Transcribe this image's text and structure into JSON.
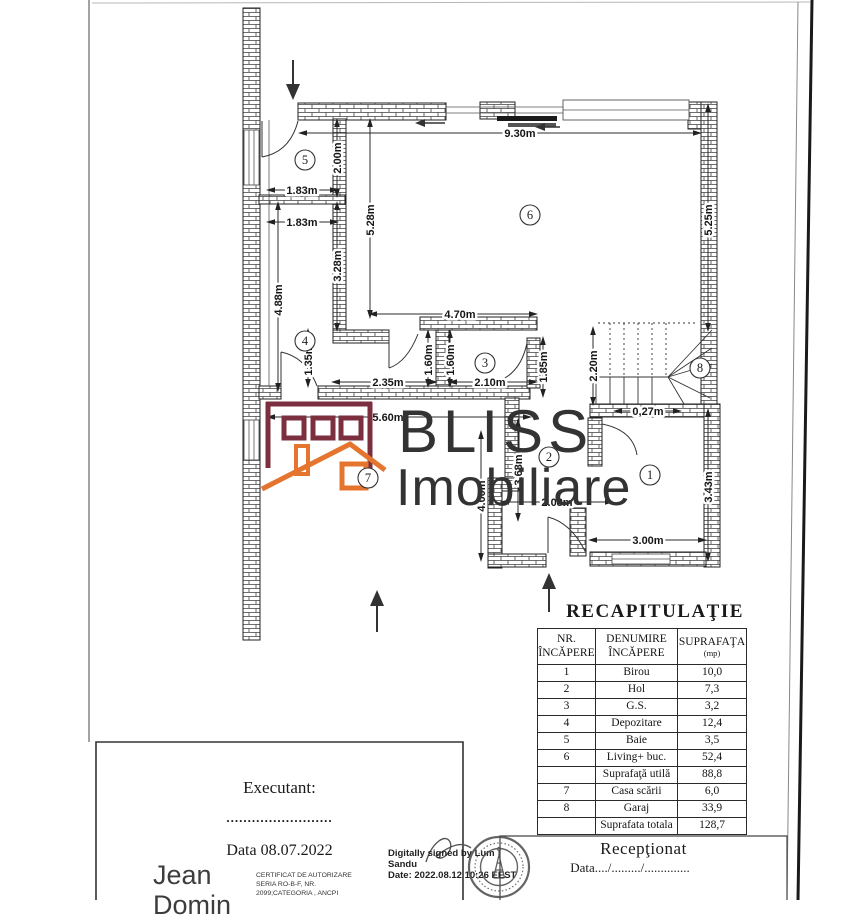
{
  "logo": {
    "title": "BLISS",
    "subtitle": "Imobiliare",
    "maroon": "#7b2f3f",
    "orange": "#e4742e"
  },
  "plan": {
    "dims": [
      "9.30m",
      "2.00m",
      "1.83m",
      "1.83m",
      "5.28m",
      "3.28m",
      "4.88m",
      "5.25m",
      "4.70m",
      "1.35m",
      "2.35m",
      "1.60m",
      "1.60m",
      "2.10m",
      "1.85m",
      "5.60m",
      "2.20m",
      "0,27m",
      "4.00m",
      "3.68m",
      "2.08m",
      "3.00m",
      "3.43m"
    ],
    "rooms": [
      "1",
      "2",
      "3",
      "4",
      "5",
      "6",
      "7",
      "8"
    ]
  },
  "recap": {
    "title": "RECAPITULAŢIE",
    "headers": {
      "col1_line1": "NR.",
      "col1_line2": "ÎNCĂPERE",
      "col2_line1": "DENUMIRE",
      "col2_line2": "ÎNCĂPERE",
      "col3_line1": "SUPRAFAŢA",
      "col3_line2": "(mp)"
    },
    "rows": [
      {
        "nr": "1",
        "name": "Birou",
        "area": "10,0"
      },
      {
        "nr": "2",
        "name": "Hol",
        "area": "7,3"
      },
      {
        "nr": "3",
        "name": "G.S.",
        "area": "3,2"
      },
      {
        "nr": "4",
        "name": "Depozitare",
        "area": "12,4"
      },
      {
        "nr": "5",
        "name": "Baie",
        "area": "3,5"
      },
      {
        "nr": "6",
        "name": "Living+ buc.",
        "area": "52,4"
      },
      {
        "nr": "",
        "name": "Suprafaţă utilă",
        "area": "88,8"
      },
      {
        "nr": "7",
        "name": "Casa scării",
        "area": "6,0"
      },
      {
        "nr": "8",
        "name": "Garaj",
        "area": "33,9"
      },
      {
        "nr": "",
        "name": "Suprafata totala",
        "area": "128,7"
      }
    ]
  },
  "executant": {
    "label": "Executant:",
    "dots": ".........................",
    "date_line": "Data 08.07.2022",
    "signer_line1": "Jean",
    "signer_line2": "Domin",
    "certificate_line1": "CERTIFICAT DE AUTORIZARE",
    "certificate_line2": "SERIA RO-B-F, NR.",
    "certificate_line3": "2099;CATEGORIA , ANCPI"
  },
  "digital_signature": {
    "line1": "Digitally signed by Lum",
    "line2": "Sandu",
    "line3": "Date: 2022.08.12 10:26 EEST"
  },
  "receptionat": {
    "title": "Recepţionat",
    "date_line": "Data..../........./.............."
  }
}
